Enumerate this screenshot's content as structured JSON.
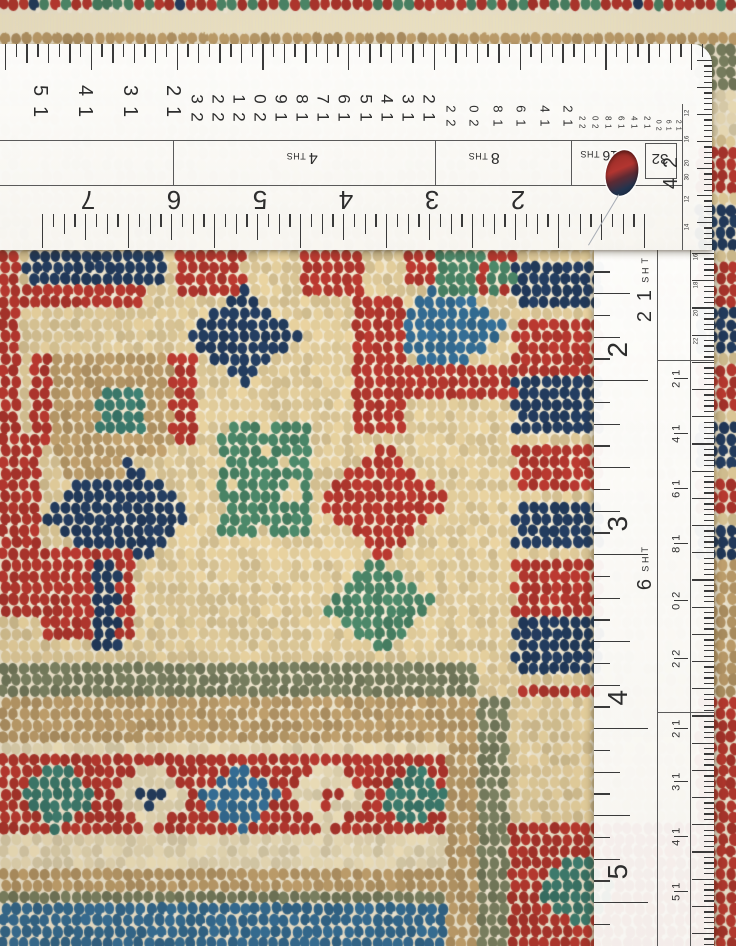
{
  "scene": {
    "description": "Close-up photograph of a hand-knotted wool rug corner being measured with two white drafting rulers"
  },
  "h_ruler": {
    "top_numbers_1": [
      "15",
      "14",
      "13",
      "12"
    ],
    "top_numbers_2": [
      "23",
      "22",
      "21",
      "20",
      "19",
      "18",
      "17",
      "16",
      "15",
      "14",
      "13",
      "12"
    ],
    "top_numbers_3": [
      "22",
      "20",
      "18",
      "16",
      "14",
      "12"
    ],
    "top_numbers_4": [
      "22",
      "20",
      "18",
      "16",
      "14",
      "12"
    ],
    "top_numbers_5": [
      "20",
      "16",
      "12"
    ],
    "section_labels": [
      {
        "num": "4",
        "suffix": "THS"
      },
      {
        "num": "8",
        "suffix": "THS"
      },
      {
        "num": "16",
        "suffix": "THS"
      },
      {
        "num": "32",
        "suffix": ""
      }
    ],
    "end_label": "24",
    "end_numbers_1": [
      "12",
      "16",
      "20",
      "30"
    ],
    "end_numbers_2": [
      "12",
      "14"
    ],
    "inch_numbers": [
      "7",
      "6",
      "5",
      "4",
      "3",
      "2"
    ]
  },
  "v_ruler": {
    "scale_labels": [
      {
        "num": "12",
        "suffix": "THS"
      },
      {
        "num": "6",
        "suffix": "THS"
      }
    ],
    "inch_numbers": [
      "2",
      "3",
      "4",
      "5"
    ],
    "right_numbers_small": [
      "16",
      "18",
      "20",
      "22"
    ],
    "right_numbers_mid": [
      "12",
      "14",
      "16",
      "18",
      "20",
      "22"
    ],
    "right_numbers_low": [
      "12",
      "13",
      "14",
      "15"
    ]
  },
  "rug": {
    "palette": {
      "cream": "#e9d3a0",
      "cream2": "#f1e3bd",
      "white": "#f8f2df",
      "red": "#bc3a31",
      "red2": "#992b25",
      "navy": "#253f63",
      "navy2": "#1a2e4a",
      "teal": "#3f8173",
      "blue": "#36719a",
      "green": "#4d8a6b",
      "sage": "#7e8565",
      "tan": "#c4a36f",
      "brown": "#97764f"
    },
    "weft_color": "#f0e7cf",
    "regions": [
      {
        "shape": "band",
        "y": [
          0,
          14
        ],
        "mix": [
          [
            "red",
            0.28
          ],
          [
            "green",
            0.18
          ],
          [
            "navy",
            0.18
          ],
          [
            "cream",
            0.2
          ],
          [
            "tan",
            0.16
          ]
        ]
      },
      {
        "shape": "fringe",
        "y": [
          14,
          34
        ]
      },
      {
        "shape": "band",
        "y": [
          34,
          50
        ],
        "mix": [
          [
            "tan",
            0.5
          ],
          [
            "brown",
            0.34
          ],
          [
            "cream2",
            0.16
          ]
        ]
      },
      {
        "shape": "band",
        "y": [
          50,
          668
        ],
        "mix": [
          [
            "cream",
            0.9
          ],
          [
            "cream2",
            0.08
          ],
          [
            "white",
            0.02
          ]
        ]
      },
      {
        "shape": "rect",
        "x": [
          0,
          24
        ],
        "y": [
          250,
          462
        ],
        "mix": [
          [
            "red",
            0.8
          ],
          [
            "red2",
            0.2
          ]
        ]
      },
      {
        "shape": "rect",
        "x": [
          26,
          170
        ],
        "y": [
          252,
          282
        ],
        "mix": [
          [
            "navy",
            0.72
          ],
          [
            "red",
            0.18
          ],
          [
            "cream",
            0.1
          ]
        ]
      },
      {
        "shape": "rect",
        "x": [
          0,
          142
        ],
        "y": [
          282,
          304
        ],
        "mix": [
          [
            "red",
            0.62
          ],
          [
            "cream",
            0.28
          ],
          [
            "navy",
            0.1
          ]
        ]
      },
      {
        "shape": "rect",
        "x": [
          176,
          244
        ],
        "y": [
          252,
          300
        ],
        "mix": [
          [
            "red",
            0.55
          ],
          [
            "cream",
            0.45
          ]
        ]
      },
      {
        "shape": "rect",
        "x": [
          300,
          364
        ],
        "y": [
          254,
          298
        ],
        "mix": [
          [
            "red",
            0.5
          ],
          [
            "cream",
            0.5
          ]
        ]
      },
      {
        "shape": "rect",
        "x": [
          408,
          484
        ],
        "y": [
          252,
          282
        ],
        "mix": [
          [
            "red",
            0.6
          ],
          [
            "cream",
            0.4
          ]
        ]
      },
      {
        "shape": "diamond",
        "c": [
          244,
          336
        ],
        "r": 58,
        "mix": [
          [
            "navy",
            0.68
          ],
          [
            "red",
            0.22
          ],
          [
            "cream",
            0.1
          ]
        ]
      },
      {
        "shape": "rect",
        "x": [
          56,
          172
        ],
        "y": [
          350,
          462
        ],
        "mix": [
          [
            "tan",
            0.72
          ],
          [
            "brown",
            0.22
          ],
          [
            "cream",
            0.06
          ]
        ]
      },
      {
        "shape": "rect",
        "x": [
          98,
          142
        ],
        "y": [
          388,
          430
        ],
        "mix": [
          [
            "teal",
            0.8
          ],
          [
            "green",
            0.2
          ]
        ]
      },
      {
        "shape": "rect",
        "x": [
          30,
          56
        ],
        "y": [
          356,
          448
        ],
        "mix": [
          [
            "red",
            0.6
          ],
          [
            "cream",
            0.4
          ]
        ]
      },
      {
        "shape": "rect",
        "x": [
          172,
          198
        ],
        "y": [
          356,
          448
        ],
        "mix": [
          [
            "red",
            0.6
          ],
          [
            "cream",
            0.4
          ]
        ]
      },
      {
        "shape": "diamond",
        "c": [
          447,
          330
        ],
        "r": 62,
        "mix": [
          [
            "blue",
            0.58
          ],
          [
            "teal",
            0.2
          ],
          [
            "cream",
            0.22
          ]
        ]
      },
      {
        "shape": "rect",
        "x": [
          356,
          404
        ],
        "y": [
          296,
          434
        ],
        "mix": [
          [
            "red",
            0.55
          ],
          [
            "cream",
            0.35
          ],
          [
            "green",
            0.1
          ]
        ]
      },
      {
        "shape": "rect",
        "x": [
          404,
          522
        ],
        "y": [
          362,
          396
        ],
        "mix": [
          [
            "red",
            0.6
          ],
          [
            "green",
            0.25
          ],
          [
            "cream",
            0.15
          ]
        ]
      },
      {
        "shape": "diamond",
        "c": [
          384,
          502
        ],
        "r": 68,
        "mix": [
          [
            "red",
            0.5
          ],
          [
            "green",
            0.28
          ],
          [
            "cream",
            0.22
          ]
        ]
      },
      {
        "shape": "diamond",
        "c": [
          380,
          606
        ],
        "r": 58,
        "mix": [
          [
            "green",
            0.55
          ],
          [
            "teal",
            0.15
          ],
          [
            "cream",
            0.3
          ]
        ]
      },
      {
        "shape": "rect",
        "x": [
          222,
          312
        ],
        "y": [
          424,
          540
        ],
        "mix": [
          [
            "green",
            0.42
          ],
          [
            "cream",
            0.48
          ],
          [
            "red",
            0.1
          ]
        ]
      },
      {
        "shape": "diamond",
        "c": [
          118,
          516
        ],
        "r": 80,
        "mix": [
          [
            "navy",
            0.7
          ],
          [
            "red",
            0.2
          ],
          [
            "cream",
            0.1
          ]
        ]
      },
      {
        "shape": "rect",
        "x": [
          0,
          40
        ],
        "y": [
          430,
          612
        ],
        "mix": [
          [
            "red",
            0.7
          ],
          [
            "cream",
            0.2
          ],
          [
            "navy",
            0.1
          ]
        ]
      },
      {
        "shape": "rect",
        "x": [
          40,
          134
        ],
        "y": [
          548,
          642
        ],
        "mix": [
          [
            "red",
            0.55
          ],
          [
            "navy",
            0.3
          ],
          [
            "cream",
            0.15
          ]
        ]
      },
      {
        "shape": "rect",
        "x": [
          92,
          120
        ],
        "y": [
          560,
          652
        ],
        "mix": [
          [
            "navy",
            0.8
          ],
          [
            "red",
            0.2
          ]
        ]
      },
      {
        "shape": "rect",
        "x": [
          64,
          122
        ],
        "y": [
          430,
          478
        ],
        "mix": [
          [
            "tan",
            0.6
          ],
          [
            "cream",
            0.4
          ]
        ]
      },
      {
        "shape": "rect",
        "x": [
          440,
          516
        ],
        "y": [
          250,
          300
        ],
        "mix": [
          [
            "green",
            0.4
          ],
          [
            "red",
            0.3
          ],
          [
            "cream",
            0.3
          ]
        ]
      },
      {
        "shape": "blocks",
        "x": [
          516,
          604
        ],
        "y": [
          252,
          706
        ],
        "h": 60,
        "colors": [
          "navy",
          "red"
        ],
        "gapc": "cream"
      },
      {
        "shape": "rect",
        "x": [
          698,
          736
        ],
        "y": [
          44,
          92
        ],
        "mix": [
          [
            "sage",
            0.66
          ],
          [
            "tan",
            0.2
          ],
          [
            "brown",
            0.14
          ]
        ]
      },
      {
        "shape": "rect",
        "x": [
          698,
          736
        ],
        "y": [
          92,
          142
        ],
        "mix": [
          [
            "cream2",
            0.5
          ],
          [
            "tan",
            0.5
          ]
        ]
      },
      {
        "shape": "blocks",
        "x": [
          698,
          736
        ],
        "y": [
          142,
          566
        ],
        "h": 54,
        "colors": [
          "red",
          "navy"
        ],
        "gapc": "cream"
      },
      {
        "shape": "rect",
        "x": [
          698,
          736
        ],
        "y": [
          566,
          700
        ],
        "mix": [
          [
            "tan",
            0.5
          ],
          [
            "cream",
            0.5
          ]
        ]
      },
      {
        "shape": "rect",
        "x": [
          698,
          736
        ],
        "y": [
          700,
          946
        ],
        "mix": [
          [
            "red",
            0.72
          ],
          [
            "red2",
            0.28
          ]
        ]
      },
      {
        "shape": "rect",
        "x": [
          0,
          478
        ],
        "y": [
          666,
          694
        ],
        "mix": [
          [
            "sage",
            0.78
          ],
          [
            "brown",
            0.22
          ]
        ]
      },
      {
        "shape": "rect",
        "x": [
          0,
          450
        ],
        "y": [
          694,
          742
        ],
        "mix": [
          [
            "tan",
            0.56
          ],
          [
            "brown",
            0.3
          ],
          [
            "cream2",
            0.14
          ]
        ]
      },
      {
        "shape": "rect",
        "x": [
          0,
          450
        ],
        "y": [
          742,
          758
        ],
        "mix": [
          [
            "cream2",
            0.85
          ],
          [
            "tan",
            0.15
          ]
        ]
      },
      {
        "shape": "rect",
        "x": [
          0,
          450
        ],
        "y": [
          758,
          840
        ],
        "mix": [
          [
            "red",
            0.86
          ],
          [
            "red2",
            0.14
          ]
        ]
      },
      {
        "shape": "diamond",
        "c": [
          58,
          798
        ],
        "r": 42,
        "mix": [
          [
            "teal",
            0.75
          ],
          [
            "green",
            0.25
          ]
        ]
      },
      {
        "shape": "diamond",
        "c": [
          152,
          798
        ],
        "r": 42,
        "mix": [
          [
            "cream2",
            0.8
          ],
          [
            "white",
            0.2
          ]
        ]
      },
      {
        "shape": "diamond",
        "c": [
          152,
          798
        ],
        "r": 15,
        "solid": "navy"
      },
      {
        "shape": "diamond",
        "c": [
          240,
          798
        ],
        "r": 42,
        "mix": [
          [
            "blue",
            0.8
          ],
          [
            "navy",
            0.2
          ]
        ]
      },
      {
        "shape": "diamond",
        "c": [
          330,
          798
        ],
        "r": 42,
        "mix": [
          [
            "cream2",
            0.8
          ],
          [
            "white",
            0.2
          ]
        ]
      },
      {
        "shape": "diamond",
        "c": [
          330,
          798
        ],
        "r": 14,
        "solid": "red"
      },
      {
        "shape": "diamond",
        "c": [
          416,
          798
        ],
        "r": 38,
        "mix": [
          [
            "teal",
            0.7
          ],
          [
            "green",
            0.3
          ]
        ]
      },
      {
        "shape": "rect",
        "x": [
          0,
          450
        ],
        "y": [
          840,
          864
        ],
        "mix": [
          [
            "cream2",
            0.8
          ],
          [
            "tan",
            0.2
          ]
        ]
      },
      {
        "shape": "rect",
        "x": [
          0,
          450
        ],
        "y": [
          864,
          888
        ],
        "mix": [
          [
            "tan",
            0.5
          ],
          [
            "brown",
            0.4
          ],
          [
            "cream",
            0.1
          ]
        ]
      },
      {
        "shape": "rect",
        "x": [
          0,
          450
        ],
        "y": [
          888,
          908
        ],
        "mix": [
          [
            "sage",
            0.8
          ],
          [
            "brown",
            0.2
          ]
        ]
      },
      {
        "shape": "rect",
        "x": [
          0,
          450
        ],
        "y": [
          908,
          946
        ],
        "mix": [
          [
            "blue",
            0.55
          ],
          [
            "navy",
            0.3
          ],
          [
            "red",
            0.08
          ],
          [
            "cream",
            0.07
          ]
        ]
      },
      {
        "shape": "rect",
        "x": [
          450,
          480
        ],
        "y": [
          694,
          946
        ],
        "mix": [
          [
            "tan",
            0.55
          ],
          [
            "brown",
            0.3
          ],
          [
            "cream",
            0.15
          ]
        ]
      },
      {
        "shape": "rect",
        "x": [
          480,
          510
        ],
        "y": [
          694,
          946
        ],
        "mix": [
          [
            "sage",
            0.78
          ],
          [
            "brown",
            0.22
          ]
        ]
      },
      {
        "shape": "rect",
        "x": [
          510,
          698
        ],
        "y": [
          700,
          824
        ],
        "mix": [
          [
            "cream",
            0.66
          ],
          [
            "green",
            0.2
          ],
          [
            "red",
            0.08
          ],
          [
            "teal",
            0.06
          ]
        ]
      },
      {
        "shape": "rect",
        "x": [
          510,
          698
        ],
        "y": [
          824,
          946
        ],
        "mix": [
          [
            "red",
            0.8
          ],
          [
            "red2",
            0.2
          ]
        ]
      },
      {
        "shape": "diamond",
        "c": [
          578,
          892
        ],
        "r": 46,
        "mix": [
          [
            "teal",
            0.5
          ],
          [
            "green",
            0.3
          ],
          [
            "cream",
            0.2
          ]
        ]
      }
    ]
  }
}
